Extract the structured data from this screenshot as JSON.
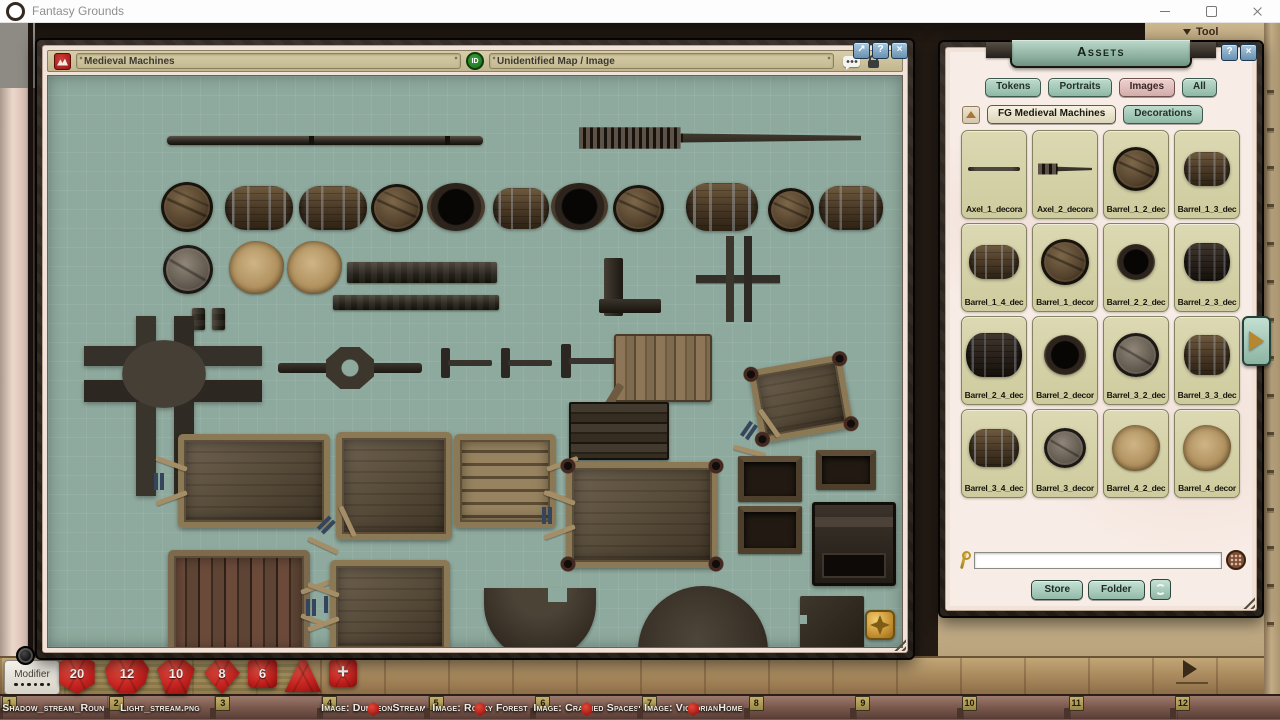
{
  "os": {
    "title": "Fantasy Grounds"
  },
  "toolbar": {
    "tool_label": "Tool"
  },
  "map_window": {
    "name_value": "Medieval Machines",
    "id_badge": "ID",
    "type_value": "Unidentified Map / Image",
    "maximize_glyph": "↗",
    "help_glyph": "?",
    "close_glyph": "×"
  },
  "assets_panel": {
    "title": "Assets",
    "help_glyph": "?",
    "close_glyph": "×",
    "tabs": [
      {
        "label": "Tokens",
        "selected": false
      },
      {
        "label": "Portraits",
        "selected": false
      },
      {
        "label": "Images",
        "selected": true
      },
      {
        "label": "All",
        "selected": false
      }
    ],
    "filters": [
      {
        "label": "FG Medieval Machines",
        "selected": true
      },
      {
        "label": "Decorations",
        "selected": false
      }
    ],
    "items": [
      {
        "label": "Axel_1_decora",
        "sprite": "axel-thin",
        "w": 52,
        "h": 4
      },
      {
        "label": "Axel_2_decora",
        "sprite": "axel2",
        "w": 54,
        "h": 14
      },
      {
        "label": "Barrel_1_2_dec",
        "sprite": "barrel-top",
        "w": 46,
        "h": 44
      },
      {
        "label": "Barrel_1_3_dec",
        "sprite": "barrel-side",
        "w": 46,
        "h": 34
      },
      {
        "label": "Barrel_1_4_dec",
        "sprite": "barrel-side",
        "w": 50,
        "h": 34
      },
      {
        "label": "Barrel_1_decor",
        "sprite": "barrel-top",
        "w": 48,
        "h": 46
      },
      {
        "label": "Barrel_2_2_dec",
        "sprite": "barrel-open",
        "w": 38,
        "h": 36
      },
      {
        "label": "Barrel_2_3_dec",
        "sprite": "barrel-side-dark",
        "w": 46,
        "h": 38
      },
      {
        "label": "Barrel_2_4_dec",
        "sprite": "barrel-side-dark",
        "w": 56,
        "h": 44
      },
      {
        "label": "Barrel_2_decor",
        "sprite": "barrel-open",
        "w": 42,
        "h": 40
      },
      {
        "label": "Barrel_3_2_dec",
        "sprite": "barrel-top-gray",
        "w": 46,
        "h": 44
      },
      {
        "label": "Barrel_3_3_dec",
        "sprite": "barrel-side",
        "w": 46,
        "h": 40
      },
      {
        "label": "Barrel_3_4_dec",
        "sprite": "barrel-side",
        "w": 50,
        "h": 38
      },
      {
        "label": "Barrel_3_decor",
        "sprite": "barrel-top-gray",
        "w": 42,
        "h": 40
      },
      {
        "label": "Barrel_4_2_dec",
        "sprite": "barrel-covered",
        "w": 48,
        "h": 46
      },
      {
        "label": "Barrel_4_decor",
        "sprite": "barrel-covered",
        "w": 48,
        "h": 46
      }
    ],
    "search_value": "",
    "store_label": "Store",
    "folder_label": "Folder"
  },
  "modifier_box": {
    "label": "Modifier",
    "dots": 6
  },
  "dice": [
    {
      "type": "d20",
      "value": "20"
    },
    {
      "type": "d12",
      "value": "12"
    },
    {
      "type": "d10",
      "value": "10"
    },
    {
      "type": "d8",
      "value": "8"
    },
    {
      "type": "d6",
      "value": "6"
    },
    {
      "type": "d4",
      "value": ""
    },
    {
      "type": "plus",
      "value": "+"
    }
  ],
  "taskbar": {
    "slots": [
      {
        "number": "1",
        "label": "Shadow_stream_Roun",
        "die_icon": false
      },
      {
        "number": "2",
        "label": "Light_stream.png",
        "die_icon": false
      },
      {
        "number": "3",
        "label": "",
        "die_icon": false
      },
      {
        "number": "4",
        "label": "Image: DungeonStream",
        "die_icon": true
      },
      {
        "number": "5",
        "label": "Image: Rocky Forest",
        "die_icon": true
      },
      {
        "number": "6",
        "label": "Image: Crashed Spacesh",
        "die_icon": true
      },
      {
        "number": "7",
        "label": "Image: VictorianHome",
        "die_icon": true
      },
      {
        "number": "8",
        "label": "",
        "die_icon": false
      },
      {
        "number": "9",
        "label": "",
        "die_icon": false
      },
      {
        "number": "10",
        "label": "",
        "die_icon": false
      },
      {
        "number": "11",
        "label": "",
        "die_icon": false
      },
      {
        "number": "12",
        "label": "",
        "die_icon": false
      }
    ]
  },
  "map_objects": [
    {
      "t": "rod",
      "x": 119,
      "y": 60,
      "w": 316,
      "h": 9
    },
    {
      "t": "axel2",
      "x": 531,
      "y": 48,
      "w": 282,
      "h": 28
    },
    {
      "t": "barrel-top",
      "x": 113,
      "y": 106,
      "w": 52,
      "h": 50
    },
    {
      "t": "barrel-side",
      "x": 177,
      "y": 110,
      "w": 68,
      "h": 44
    },
    {
      "t": "barrel-side",
      "x": 251,
      "y": 110,
      "w": 68,
      "h": 44
    },
    {
      "t": "barrel-top",
      "x": 323,
      "y": 108,
      "w": 52,
      "h": 48
    },
    {
      "t": "barrel-open",
      "x": 379,
      "y": 107,
      "w": 58,
      "h": 48
    },
    {
      "t": "barrel-side",
      "x": 445,
      "y": 112,
      "w": 56,
      "h": 41
    },
    {
      "t": "barrel-open",
      "x": 503,
      "y": 107,
      "w": 57,
      "h": 47
    },
    {
      "t": "barrel-top",
      "x": 565,
      "y": 109,
      "w": 51,
      "h": 47
    },
    {
      "t": "barrel-side",
      "x": 638,
      "y": 107,
      "w": 72,
      "h": 48
    },
    {
      "t": "barrel-top",
      "x": 720,
      "y": 112,
      "w": 46,
      "h": 44
    },
    {
      "t": "barrel-side",
      "x": 771,
      "y": 110,
      "w": 64,
      "h": 44
    },
    {
      "t": "barrel-top-gray",
      "x": 115,
      "y": 169,
      "w": 50,
      "h": 49
    },
    {
      "t": "barrel-covered",
      "x": 181,
      "y": 165,
      "w": 55,
      "h": 53
    },
    {
      "t": "barrel-covered",
      "x": 239,
      "y": 165,
      "w": 55,
      "h": 53
    },
    {
      "t": "beam-v",
      "x": 144,
      "y": 232,
      "w": 13,
      "h": 22
    },
    {
      "t": "beam-v",
      "x": 164,
      "y": 232,
      "w": 13,
      "h": 22
    },
    {
      "t": "beam-h",
      "x": 299,
      "y": 186,
      "w": 150,
      "h": 21
    },
    {
      "t": "beam-h",
      "x": 285,
      "y": 219,
      "w": 166,
      "h": 15
    },
    {
      "t": "lbeam",
      "x": 551,
      "y": 182,
      "w": 62,
      "h": 58
    },
    {
      "t": "cross-thin",
      "x": 648,
      "y": 160,
      "w": 84,
      "h": 86
    },
    {
      "t": "cross2",
      "x": 36,
      "y": 240,
      "w": 178,
      "h": 180
    },
    {
      "t": "hub-rod",
      "x": 230,
      "y": 272,
      "w": 144,
      "h": 40
    },
    {
      "t": "t-tool",
      "x": 392,
      "y": 272,
      "w": 52,
      "h": 30
    },
    {
      "t": "t-tool",
      "x": 452,
      "y": 272,
      "w": 52,
      "h": 30
    },
    {
      "t": "t-tool",
      "x": 512,
      "y": 268,
      "w": 58,
      "h": 34
    },
    {
      "t": "raft",
      "x": 566,
      "y": 258,
      "w": 94,
      "h": 64
    },
    {
      "t": "cart-wheels",
      "x": 706,
      "y": 286,
      "w": 94,
      "h": 74,
      "r": -10,
      "handle": "bl"
    },
    {
      "t": "plank-pile",
      "x": 521,
      "y": 326,
      "w": 96,
      "h": 54
    },
    {
      "t": "cart-open",
      "x": 130,
      "y": 358,
      "w": 152,
      "h": 94,
      "handle": "l"
    },
    {
      "t": "cart-open",
      "x": 288,
      "y": 356,
      "w": 116,
      "h": 108,
      "handle": "bl"
    },
    {
      "t": "cart-frame",
      "x": 406,
      "y": 358,
      "w": 102,
      "h": 94,
      "handle": "r"
    },
    {
      "t": "cart-wheels",
      "x": 518,
      "y": 386,
      "w": 152,
      "h": 106,
      "handle": "l"
    },
    {
      "t": "crate-open",
      "x": 690,
      "y": 380,
      "w": 64,
      "h": 46
    },
    {
      "t": "crate-open",
      "x": 768,
      "y": 374,
      "w": 60,
      "h": 40
    },
    {
      "t": "crate-open",
      "x": 690,
      "y": 430,
      "w": 64,
      "h": 48
    },
    {
      "t": "chest",
      "x": 764,
      "y": 426,
      "w": 84,
      "h": 84
    },
    {
      "t": "cart-red",
      "x": 120,
      "y": 474,
      "w": 142,
      "h": 108,
      "handle": "r"
    },
    {
      "t": "cart-open",
      "x": 282,
      "y": 484,
      "w": 120,
      "h": 94,
      "handle": "l"
    },
    {
      "t": "semicircle-notch",
      "x": 436,
      "y": 512,
      "w": 112,
      "h": 72
    },
    {
      "t": "disc",
      "x": 590,
      "y": 510,
      "w": 130,
      "h": 130
    },
    {
      "t": "slab",
      "x": 752,
      "y": 520,
      "w": 64,
      "h": 62
    }
  ],
  "colors": {
    "canvas_teal": "#8ea99d",
    "parchment": "#f2e3da",
    "button_green": "#a9cfc0",
    "selected_pink": "#e0c4c1",
    "die_red": "#c4231d",
    "gold": "#c69132"
  }
}
